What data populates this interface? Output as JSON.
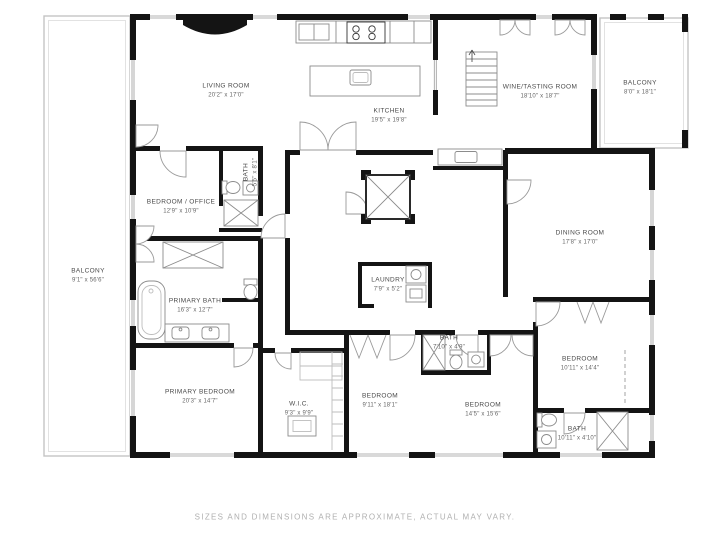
{
  "colors": {
    "walls": "#141414",
    "labels": "#4a4a4a",
    "fixture_lines": "#8c8c8c",
    "disclaimer_text": "#b0b0b0",
    "background": "#ffffff"
  },
  "rooms": [
    {
      "id": "living-room",
      "name": "LIVING ROOM",
      "dims": "20'2\" x 17'0\""
    },
    {
      "id": "kitchen",
      "name": "KITCHEN",
      "dims": "19'5\" x 19'8\""
    },
    {
      "id": "wine-tasting",
      "name": "WINE/TASTING ROOM",
      "dims": "18'10\" x 18'7\""
    },
    {
      "id": "balcony-right",
      "name": "BALCONY",
      "dims": "8'0\" x 18'1\""
    },
    {
      "id": "bedroom-office",
      "name": "BEDROOM / OFFICE",
      "dims": "12'9\" x 10'9\""
    },
    {
      "id": "bath-small",
      "name": "BATH",
      "dims": "5'5\" x 8'1\""
    },
    {
      "id": "balcony-left",
      "name": "BALCONY",
      "dims": "9'1\" x 56'6\""
    },
    {
      "id": "primary-bath",
      "name": "PRIMARY BATH",
      "dims": "16'3\" x 12'7\""
    },
    {
      "id": "laundry",
      "name": "LAUNDRY",
      "dims": "7'9\" x 5'2\""
    },
    {
      "id": "dining-room",
      "name": "DINING ROOM",
      "dims": "17'8\" x 17'0\""
    },
    {
      "id": "primary-bedroom",
      "name": "PRIMARY BEDROOM",
      "dims": "20'3\" x 14'7\""
    },
    {
      "id": "wic",
      "name": "W.I.C.",
      "dims": "9'3\" x 9'9\""
    },
    {
      "id": "bedroom-1",
      "name": "BEDROOM",
      "dims": "9'11\" x 18'1\""
    },
    {
      "id": "bath-hall",
      "name": "BATH",
      "dims": "7'10\" x 4'9\""
    },
    {
      "id": "bedroom-2",
      "name": "BEDROOM",
      "dims": "14'5\" x 15'6\""
    },
    {
      "id": "bedroom-3",
      "name": "BEDROOM",
      "dims": "10'11\" x 14'4\""
    },
    {
      "id": "bath-ensuite",
      "name": "BATH",
      "dims": "10'11\" x 4'10\""
    }
  ],
  "footer": {
    "disclaimer": "SIZES AND DIMENSIONS ARE APPROXIMATE, ACTUAL MAY VARY."
  }
}
